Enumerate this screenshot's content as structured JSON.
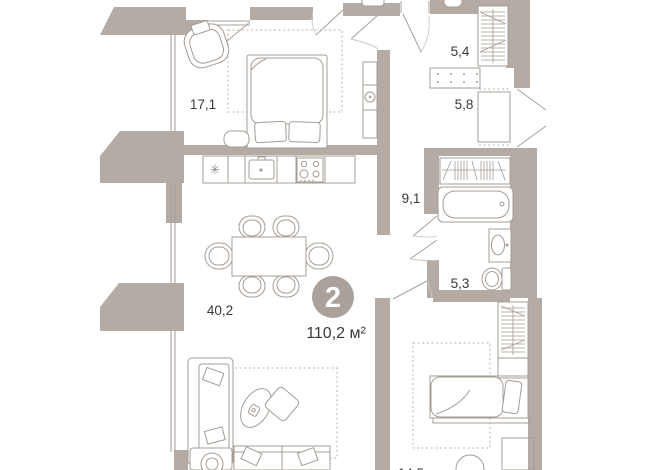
{
  "plan": {
    "badge": {
      "rooms_count": "2",
      "total_area": "110,2 м²"
    },
    "rooms": [
      {
        "name": "bedroom-1",
        "area_label": "17,1"
      },
      {
        "name": "entry-hall",
        "area_label": "5,4"
      },
      {
        "name": "hallway",
        "area_label": "5,8"
      },
      {
        "name": "corridor",
        "area_label": "9,1"
      },
      {
        "name": "wc",
        "area_label": "5,3"
      },
      {
        "name": "living-room-kitchen",
        "area_label": "40,2"
      },
      {
        "name": "bedroom-2",
        "area_label": "14,5"
      }
    ],
    "symbols": {
      "fridge": "✳"
    },
    "colors": {
      "wall": "#b3aba4",
      "furniture_line": "#a59c94",
      "badge_fill": "#a9a19a",
      "label_text": "#3d3935"
    }
  }
}
